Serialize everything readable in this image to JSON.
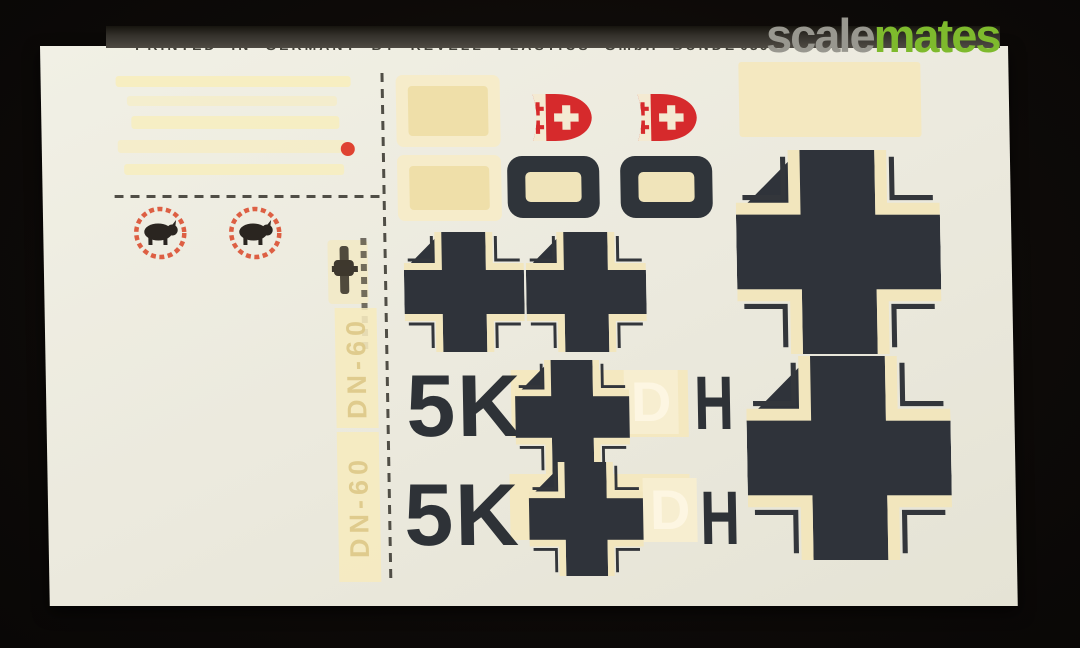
{
  "watermark": {
    "site_name_gray": "scale",
    "site_name_green": "mates"
  },
  "sheet": {
    "printed_line": "PRINTED IN GERMANY BY REVELL PLASTICS GmbH BÜNDE",
    "part_number": "0367",
    "vertical_code_top": "DN-60",
    "vertical_code_bottom": "DN-60",
    "code_rows": [
      {
        "left": "5K",
        "center": "D",
        "right": "H"
      },
      {
        "left": "5K",
        "center": "D",
        "right": "H"
      }
    ]
  },
  "colors": {
    "decal_black": "#2f343a",
    "decal_cream": "#f4e8c0",
    "decal_red": "#d62a2c",
    "wreath_red": "#dd5f43",
    "logo_green": "#7eba2d",
    "logo_gray": "#98978f",
    "paper": "#ebe9dd",
    "background": "#0d0a08"
  },
  "icons": {
    "balkenkreuz": "german-balkenkreuz-cross",
    "boar_emblem": "boar-in-red-wreath-badge",
    "crest_shield": "red-white-crest-shield",
    "letter_d_ring": "black-rounded-d-marking",
    "red_dot": "red-dot-marking"
  }
}
